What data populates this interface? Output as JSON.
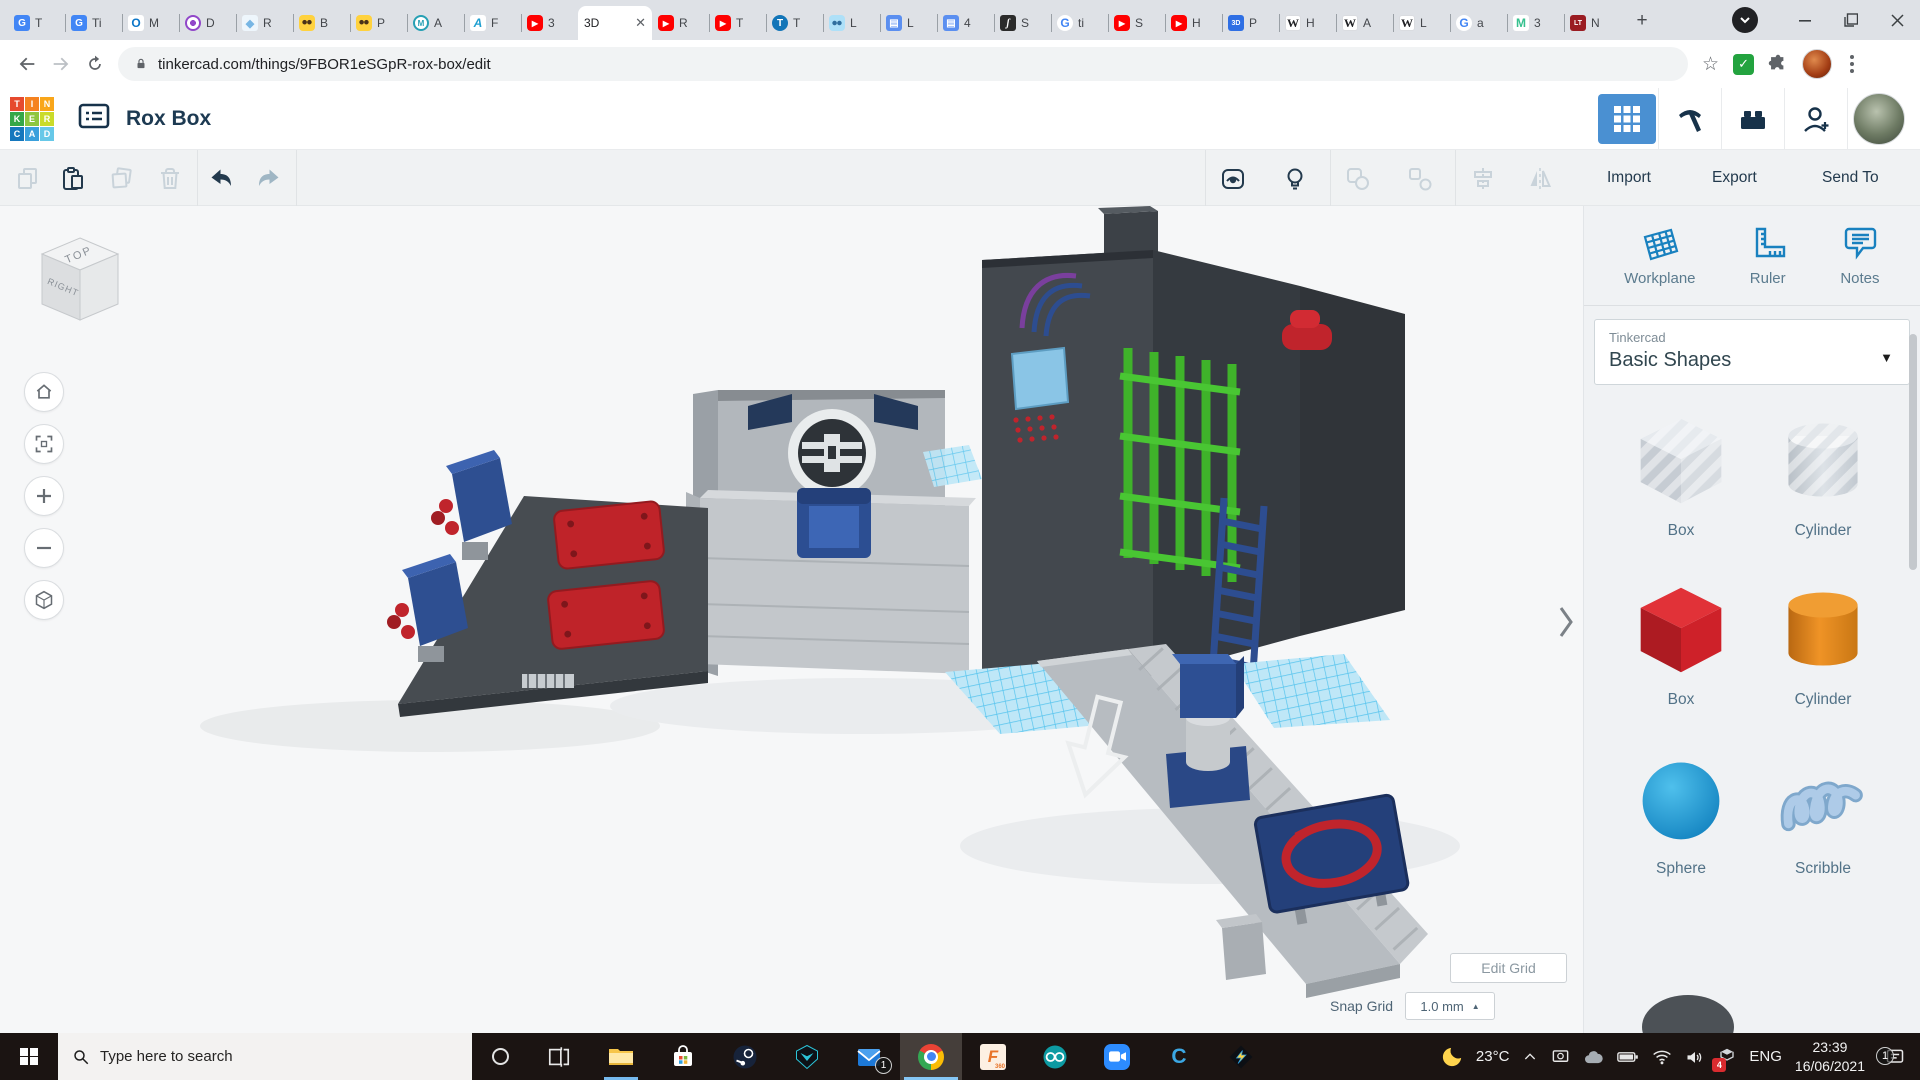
{
  "colors": {
    "accent_blue": "#4a90d2",
    "tinkercad_icon_blue": "#1981bf",
    "shape_red": "#c0242c",
    "shape_orange": "#e0821c",
    "shape_sphere_blue": "#1ba0dc",
    "model_green": "#3fb32a",
    "model_navy": "#2d4d90",
    "taskbar_bg": "#1b1412"
  },
  "browser": {
    "url": "tinkercad.com/things/9FBOR1eSGpR-rox-box/edit",
    "new_tab_label": "+",
    "tabs": [
      {
        "fav": "gtranslate",
        "label": "T"
      },
      {
        "fav": "gtranslate",
        "label": "Ti"
      },
      {
        "fav": "outlook",
        "label": "M"
      },
      {
        "fav": "drift",
        "label": "D"
      },
      {
        "fav": "resin",
        "label": "R"
      },
      {
        "fav": "bee",
        "label": "B"
      },
      {
        "fav": "bee",
        "label": "P"
      },
      {
        "fav": "hex",
        "label": "A"
      },
      {
        "fav": "autodesk",
        "label": "F"
      },
      {
        "fav": "youtube",
        "label": "3"
      },
      {
        "fav": "none",
        "label": "3D",
        "active": true,
        "close": "✕"
      },
      {
        "fav": "youtube",
        "label": "R"
      },
      {
        "fav": "youtube",
        "label": "T"
      },
      {
        "fav": "thingiverse",
        "label": "T"
      },
      {
        "fav": "ldd",
        "label": "L"
      },
      {
        "fav": "book",
        "label": "L"
      },
      {
        "fav": "book",
        "label": "4"
      },
      {
        "fav": "js",
        "label": "S"
      },
      {
        "fav": "google",
        "label": "ti"
      },
      {
        "fav": "youtube",
        "label": "S"
      },
      {
        "fav": "youtube",
        "label": "H"
      },
      {
        "fav": "3dp",
        "label": "P"
      },
      {
        "fav": "wiki",
        "label": "H"
      },
      {
        "fav": "wiki",
        "label": "A"
      },
      {
        "fav": "wiki",
        "label": "L"
      },
      {
        "fav": "google",
        "label": "a"
      },
      {
        "fav": "mc",
        "label": "3"
      },
      {
        "fav": "lt",
        "label": "N"
      }
    ]
  },
  "app": {
    "title": "Rox Box",
    "logo_letters": [
      "T",
      "I",
      "N",
      "K",
      "E",
      "R",
      "C",
      "A",
      "D"
    ],
    "logo_colors": [
      "#e64a2e",
      "#f58220",
      "#f9a61a",
      "#35a748",
      "#8dc63f",
      "#cadb2a",
      "#1577bd",
      "#3aa0dc",
      "#67c8e8"
    ]
  },
  "toolbar": {
    "import_label": "Import",
    "export_label": "Export",
    "send_to_label": "Send To"
  },
  "canvas": {
    "viewcube_top": "TOP",
    "viewcube_right": "RIGHT",
    "edit_grid_label": "Edit Grid",
    "snap_grid_label": "Snap Grid",
    "snap_grid_value": "1.0 mm"
  },
  "panel": {
    "tools": [
      {
        "id": "workplane",
        "label": "Workplane"
      },
      {
        "id": "ruler",
        "label": "Ruler"
      },
      {
        "id": "notes",
        "label": "Notes"
      }
    ],
    "library_brand": "Tinkercad",
    "library_title": "Basic Shapes",
    "shapes": [
      {
        "variant": "box-striped",
        "label": "Box"
      },
      {
        "variant": "cylinder-striped",
        "label": "Cylinder"
      },
      {
        "variant": "box-red",
        "label": "Box"
      },
      {
        "variant": "cylinder-orange",
        "label": "Cylinder"
      },
      {
        "variant": "sphere-blue",
        "label": "Sphere"
      },
      {
        "variant": "scribble",
        "label": "Scribble"
      }
    ]
  },
  "taskbar": {
    "search_placeholder": "Type here to search",
    "temperature": "23°C",
    "language": "ENG",
    "time": "23:39",
    "date": "16/06/2021",
    "notification_count": "1",
    "apps": [
      {
        "id": "task-view"
      },
      {
        "id": "explorer",
        "open": true
      },
      {
        "id": "store"
      },
      {
        "id": "steam"
      },
      {
        "id": "predator"
      },
      {
        "id": "mail",
        "badge": "1"
      },
      {
        "id": "chrome",
        "active": true
      },
      {
        "id": "fusion"
      },
      {
        "id": "arduino"
      },
      {
        "id": "zoom"
      },
      {
        "id": "cura"
      },
      {
        "id": "voxelab"
      }
    ]
  }
}
